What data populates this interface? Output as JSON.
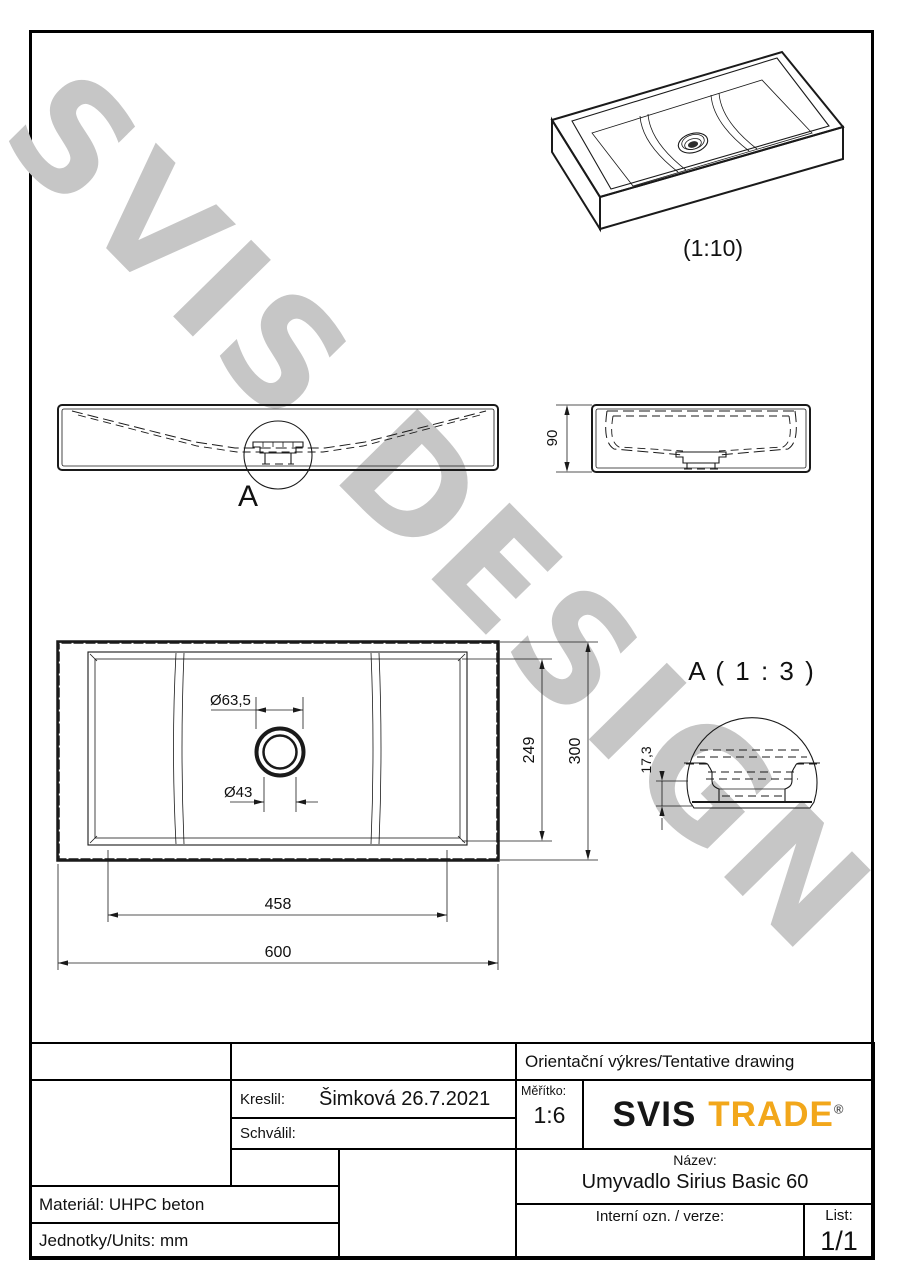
{
  "watermark": "SVIS DESIGN",
  "iso_view": {
    "scale_label": "(1:10)"
  },
  "front_view": {
    "detail_label": "A"
  },
  "side_view": {
    "dim_height": "90"
  },
  "plan_view": {
    "dim_drain_outer": "Ø63,5",
    "dim_drain_inner": "Ø43",
    "dim_basin_y": "249",
    "dim_overall_y": "300",
    "dim_basin_x": "458",
    "dim_overall_x": "600"
  },
  "detail_view": {
    "title": "A ( 1 : 3 )",
    "dim_depth": "17,3"
  },
  "title_block": {
    "orientation_note": "Orientační výkres/Tentative drawing",
    "drawn_label": "Kreslil:",
    "drawn_value": "Šimková 26.7.2021",
    "approved_label": "Schválil:",
    "scale_label": "Měřítko:",
    "scale_value": "1:6",
    "logo_part1": "SVIS",
    "logo_part2": "TRADE",
    "logo_reg": "®",
    "name_label": "Název:",
    "name_value": "Umyvadlo Sirius Basic 60",
    "material": "Materiál: UHPC beton",
    "units": "Jednotky/Units: mm",
    "internal_label": "Interní ozn. / verze:",
    "sheet_label": "List:",
    "sheet_value": "1/1"
  }
}
